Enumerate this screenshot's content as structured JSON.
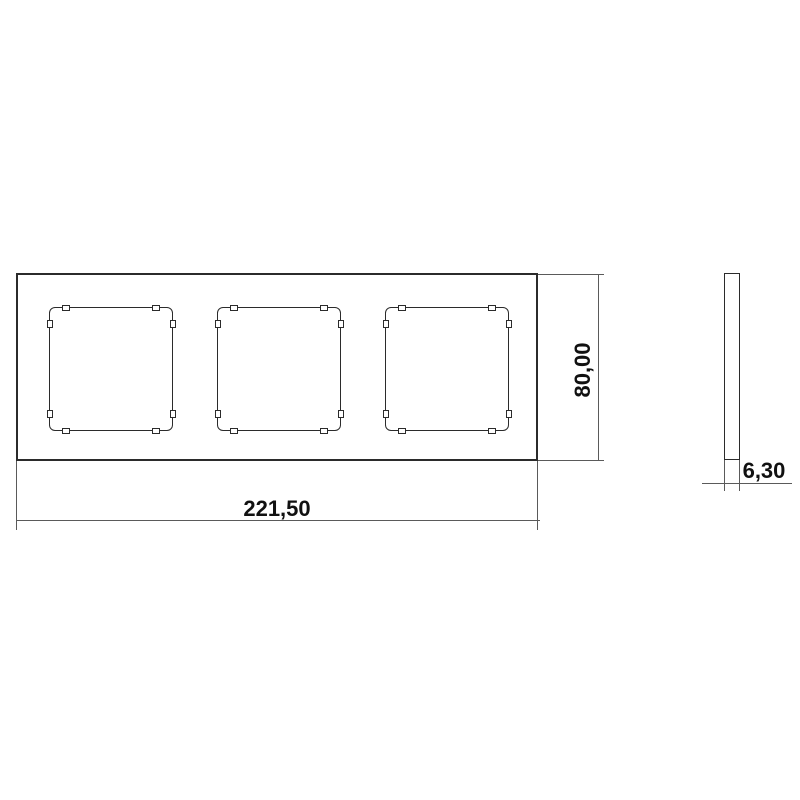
{
  "colors": {
    "background": "#ffffff",
    "ink": "#2b2b2b",
    "dim_line": "#5a5a5a",
    "text": "#111111"
  },
  "drawing": {
    "front_view": {
      "openings_count": 3
    },
    "dimensions": {
      "width": {
        "value": "221,50"
      },
      "height": {
        "value": "80,00"
      },
      "thickness": {
        "value": "6,30"
      }
    }
  }
}
